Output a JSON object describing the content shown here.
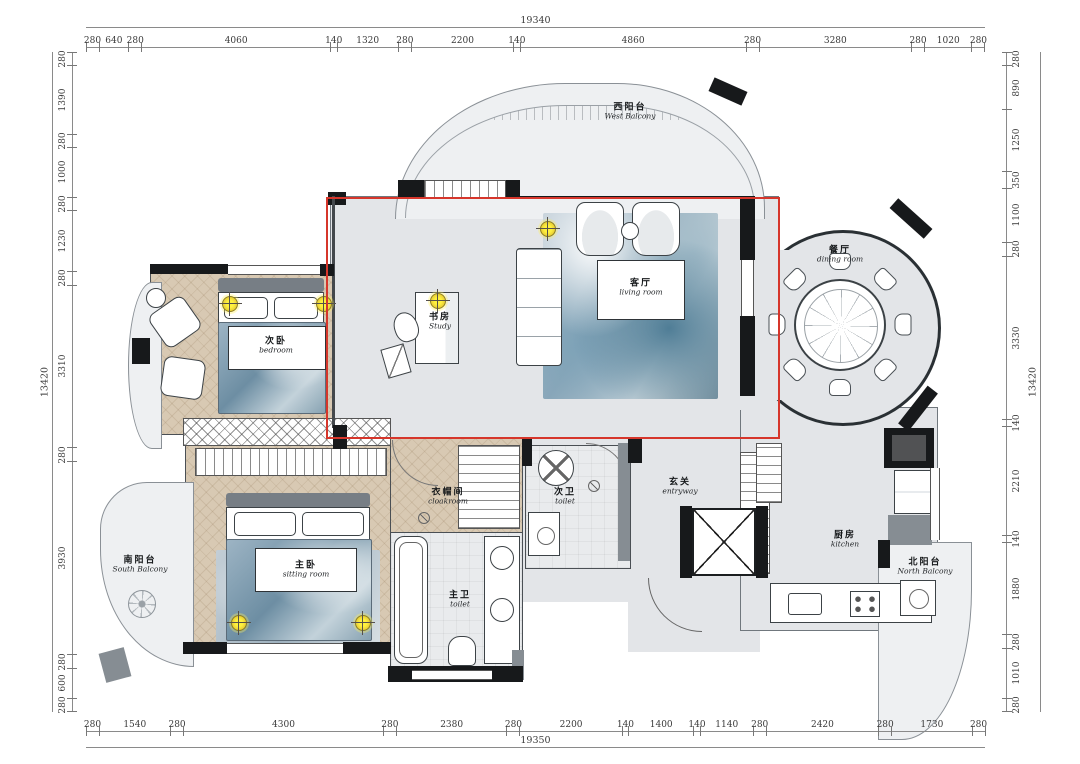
{
  "dimensions": {
    "top": {
      "total": "19340",
      "segments": [
        280,
        640,
        280,
        4060,
        140,
        1320,
        280,
        2200,
        140,
        4860,
        280,
        3280,
        280,
        1020,
        280
      ]
    },
    "bottom": {
      "total": "19350",
      "segments": [
        280,
        1540,
        280,
        4300,
        280,
        2380,
        280,
        2200,
        140,
        1400,
        140,
        1140,
        280,
        2420,
        280,
        1730,
        280
      ]
    },
    "left": {
      "total": "13420",
      "segments": [
        280,
        1390,
        280,
        1000,
        280,
        1230,
        280,
        3310,
        280,
        3930,
        280,
        600,
        280
      ]
    },
    "right": {
      "total": "13420",
      "segments": [
        280,
        890,
        1250,
        350,
        1100,
        280,
        3330,
        140,
        2210,
        140,
        1880,
        280,
        1010,
        280
      ]
    }
  },
  "rooms": [
    {
      "id": "west-balcony",
      "zh": "西阳台",
      "en": "West Balcony"
    },
    {
      "id": "dining-room",
      "zh": "餐厅",
      "en": "dining room"
    },
    {
      "id": "living-room",
      "zh": "客厅",
      "en": "living room"
    },
    {
      "id": "study",
      "zh": "书房",
      "en": "Study"
    },
    {
      "id": "bedroom",
      "zh": "次卧",
      "en": "bedroom"
    },
    {
      "id": "master-bedroom",
      "zh": "主卧",
      "en": "sitting room"
    },
    {
      "id": "cloakroom",
      "zh": "衣帽间",
      "en": "cloakroom"
    },
    {
      "id": "guest-toilet",
      "zh": "次卫",
      "en": "toilet"
    },
    {
      "id": "entryway",
      "zh": "玄关",
      "en": "entryway"
    },
    {
      "id": "master-toilet",
      "zh": "主卫",
      "en": "toilet"
    },
    {
      "id": "kitchen",
      "zh": "厨房",
      "en": "kitchen"
    },
    {
      "id": "north-balcony",
      "zh": "北阳台",
      "en": "North Balcony"
    },
    {
      "id": "south-balcony",
      "zh": "南阳台",
      "en": "South Balcony"
    }
  ],
  "colors": {
    "highlight_box": "#d6362b",
    "wall": "#17191b",
    "wood_floor": "#d8c9b3",
    "gray_floor": "#e3e5e8",
    "rug_blue": "#7fa3b8",
    "light_symbol": "#efd83a"
  }
}
